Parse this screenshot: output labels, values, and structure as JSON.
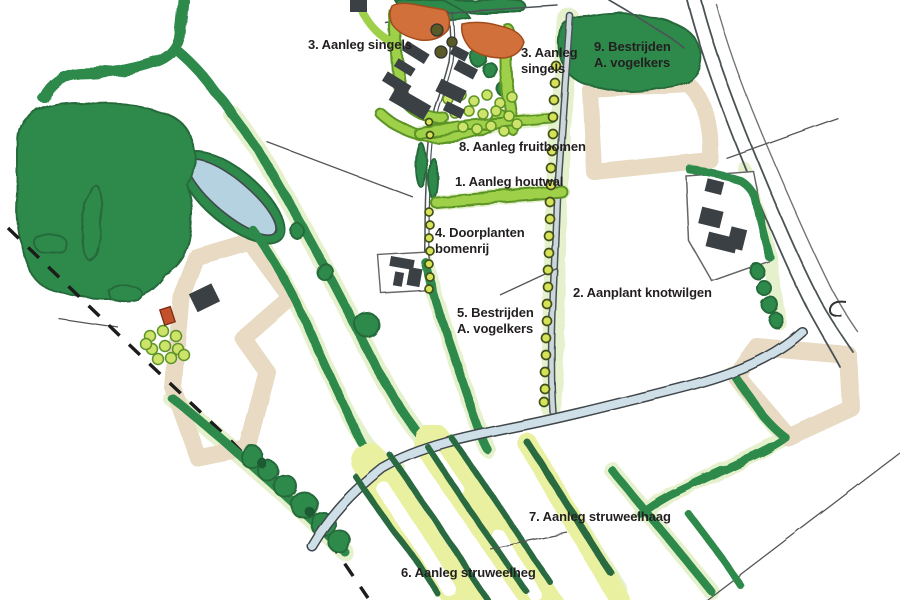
{
  "annotations": [
    {
      "number": "3",
      "lines": [
        "3. Aanleg singels"
      ]
    },
    {
      "number": "3",
      "lines": [
        "3. Aanleg",
        "singels"
      ]
    },
    {
      "number": "9",
      "lines": [
        "9. Bestrijden",
        "A. vogelkers"
      ]
    },
    {
      "number": "8",
      "lines": [
        "8. Aanleg fruitbomen"
      ]
    },
    {
      "number": "1",
      "lines": [
        "1. Aanleg houtwal"
      ]
    },
    {
      "number": "4",
      "lines": [
        "4. Doorplanten",
        "bomenrij"
      ]
    },
    {
      "number": "2",
      "lines": [
        "2. Aanplant knotwilgen"
      ]
    },
    {
      "number": "5",
      "lines": [
        "5. Bestrijden",
        "A. vogelkers"
      ]
    },
    {
      "number": "7",
      "lines": [
        "7. Aanleg struweelhaag"
      ]
    },
    {
      "number": "6",
      "lines": [
        "6. Aanleg struweelheg"
      ]
    }
  ],
  "colors": {
    "ink": "#231f20",
    "woods": "#2f8a4c",
    "woodsEdge": "#256b3b",
    "hedgeDark": "#2c6b3f",
    "singel": "#9ed049",
    "singelEdge": "#5d9427",
    "glow": "#e2f0c6",
    "water": "#b5d2e0",
    "stream": "#cfdfe8",
    "beige": "#e8dac3",
    "road": "#4c5356",
    "building": "#3b4044",
    "roof": "#d2703c",
    "orchard": "#cde36a",
    "knotwilg": "#d7e356",
    "band": "#e9f0a0"
  }
}
